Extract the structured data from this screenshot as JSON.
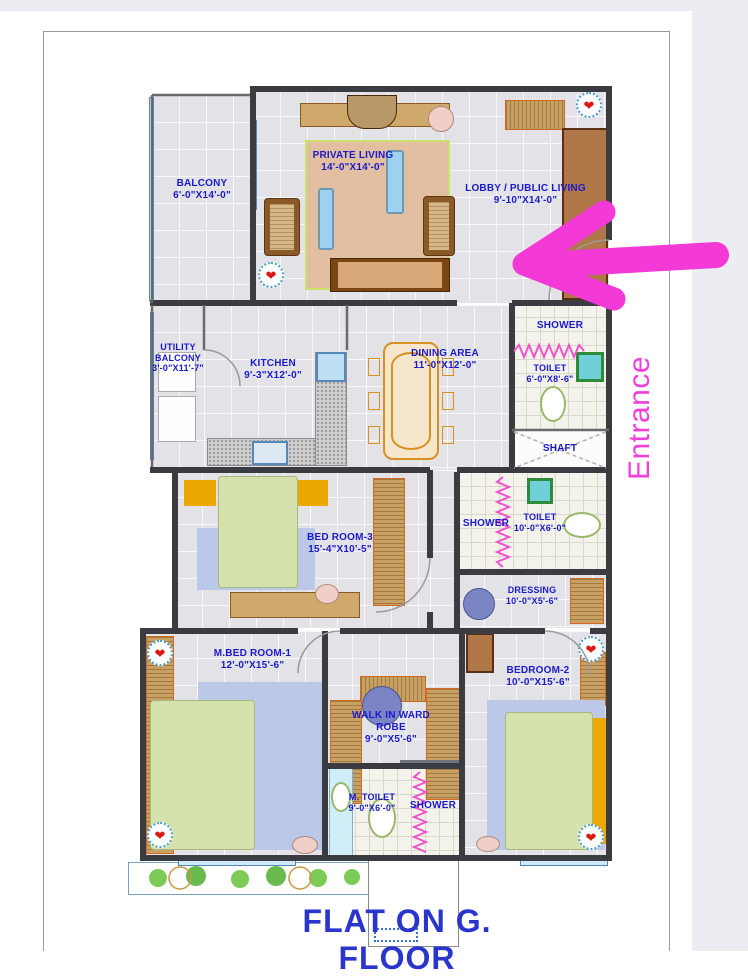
{
  "meta": {
    "title": "FLAT ON G. FLOOR",
    "entrance_label": "Entrance"
  },
  "colors": {
    "label_blue": "#1a1acc",
    "title_blue": "#2a35cc",
    "annotation_pink": "#f43ad6",
    "wall_dark": "#3a3c42"
  },
  "glyphs": {
    "fan": "❤"
  },
  "rooms": {
    "balcony": {
      "name": "BALCONY",
      "dims": "6'-0\"X14'-0\""
    },
    "private_living": {
      "name": "PRIVATE LIVING",
      "dims": "14'-0\"X14'-0\""
    },
    "lobby": {
      "name": "LOBBY / PUBLIC LIVING",
      "dims": "9'-10\"X14'-0\""
    },
    "utility_balcony": {
      "name": "UTILITY BALCONY",
      "dims": "3'-0\"X11'-7\""
    },
    "kitchen": {
      "name": "KITCHEN",
      "dims": "9'-3\"X12'-0\""
    },
    "dining": {
      "name": "DINING AREA",
      "dims": "11'-0\"X12'-0\""
    },
    "shower1": {
      "name": "SHOWER"
    },
    "toilet1": {
      "name": "TOILET",
      "dims": "6'-0\"X8'-6\""
    },
    "shaft": {
      "name": "SHAFT"
    },
    "bedroom3": {
      "name": "BED ROOM-3",
      "dims": "15'-4\"X10'-5\""
    },
    "shower2": {
      "name": "SHOWER"
    },
    "toilet2": {
      "name": "TOILET",
      "dims": "10'-0\"X6'-0\""
    },
    "dressing": {
      "name": "DRESSING",
      "dims": "10'-0\"X5'-6\""
    },
    "mbedroom1": {
      "name": "M.BED ROOM-1",
      "dims": "12'-0\"X15'-6\""
    },
    "walkin": {
      "name": "WALK IN WARD ROBE",
      "dims": "9'-0\"X5'-6\""
    },
    "mtoilet": {
      "name": "M. TOILET",
      "dims": "9'-0\"X6'-0\""
    },
    "shower3": {
      "name": "SHOWER"
    },
    "bedroom2": {
      "name": "BEDROOM-2",
      "dims": "10'-0\"X15'-6\""
    }
  }
}
